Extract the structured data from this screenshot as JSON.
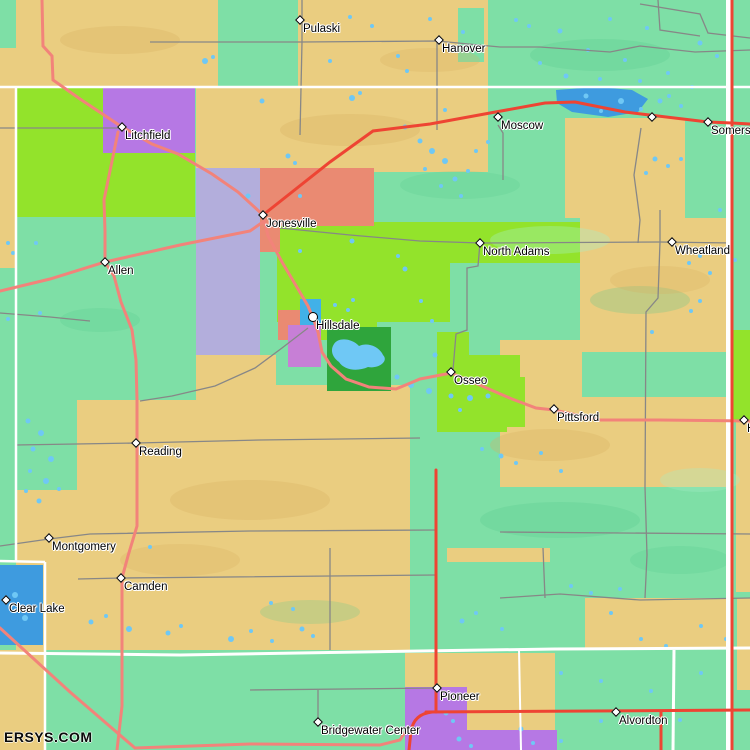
{
  "map": {
    "watermark": "ERSYS.COM",
    "towns": [
      {
        "name": "Pulaski",
        "x": 300,
        "y": 20,
        "marker": "diamond"
      },
      {
        "name": "Hanover",
        "x": 439,
        "y": 40,
        "marker": "diamond"
      },
      {
        "name": "Moscow",
        "x": 498,
        "y": 117,
        "marker": "diamond"
      },
      {
        "name": "",
        "x": 652,
        "y": 117,
        "marker": "diamond"
      },
      {
        "name": "Somerset",
        "x": 708,
        "y": 122,
        "marker": "diamond"
      },
      {
        "name": "Litchfield",
        "x": 122,
        "y": 127,
        "marker": "diamond"
      },
      {
        "name": "Jonesville",
        "x": 263,
        "y": 215,
        "marker": "diamond"
      },
      {
        "name": "North Adams",
        "x": 480,
        "y": 243,
        "marker": "diamond"
      },
      {
        "name": "Wheatland",
        "x": 672,
        "y": 242,
        "marker": "diamond"
      },
      {
        "name": "Allen",
        "x": 105,
        "y": 262,
        "marker": "diamond"
      },
      {
        "name": "Hillsdale",
        "x": 313,
        "y": 317,
        "marker": "circle"
      },
      {
        "name": "Osseo",
        "x": 451,
        "y": 372,
        "marker": "diamond"
      },
      {
        "name": "Pittsford",
        "x": 554,
        "y": 409,
        "marker": "diamond"
      },
      {
        "name": "H",
        "x": 744,
        "y": 420,
        "marker": "diamond"
      },
      {
        "name": "Reading",
        "x": 136,
        "y": 443,
        "marker": "diamond"
      },
      {
        "name": "Montgomery",
        "x": 49,
        "y": 538,
        "marker": "diamond"
      },
      {
        "name": "Camden",
        "x": 121,
        "y": 578,
        "marker": "diamond"
      },
      {
        "name": "Clear Lake",
        "x": 6,
        "y": 600,
        "marker": "diamond"
      },
      {
        "name": "Pioneer",
        "x": 437,
        "y": 688,
        "marker": "diamond"
      },
      {
        "name": "Bridgewater Center",
        "x": 318,
        "y": 722,
        "marker": "diamond"
      },
      {
        "name": "Alvordton",
        "x": 616,
        "y": 712,
        "marker": "diamond"
      }
    ],
    "palette": {
      "land_teal": "#7EDFA6",
      "land_tan": "#EACD80",
      "land_chartreuse": "#93E32B",
      "land_purple": "#B678E4",
      "land_lavender": "#B3AEDC",
      "land_salmon": "#EA8A72",
      "land_dark_green": "#2FA53C",
      "city_violet": "#C77FD6",
      "city_blue": "#41B1E8",
      "lake_light_blue": "#6FC8F5",
      "lake_deep_blue": "#3E9BDF",
      "road_major_red": "#EE4433",
      "road_secondary_pink": "#F2837A",
      "road_minor_gray": "#878787",
      "boundary_white": "#FFFFFF",
      "label_color": "#000000"
    }
  }
}
